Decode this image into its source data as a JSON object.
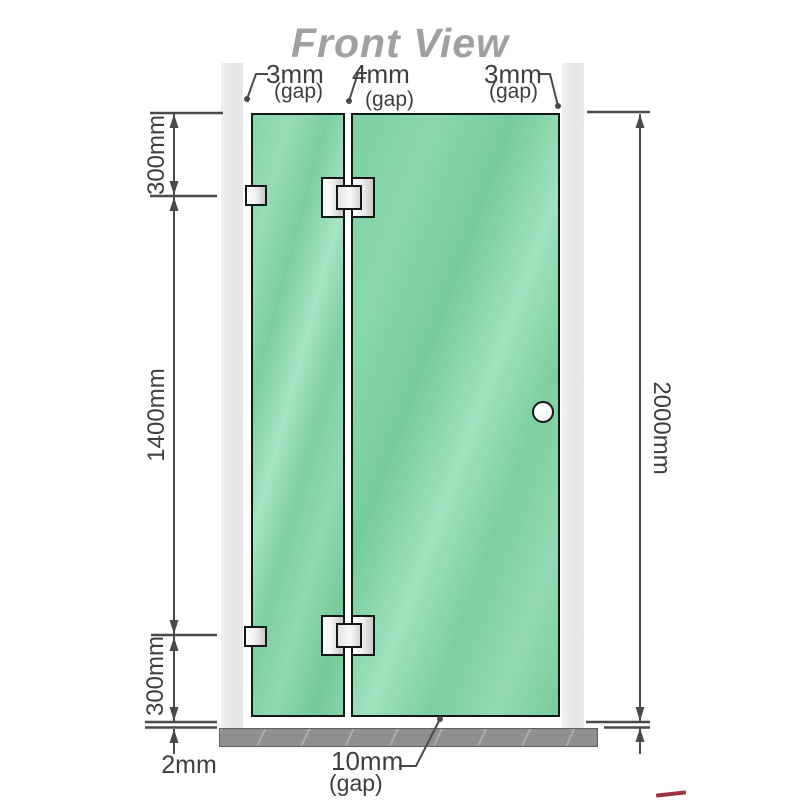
{
  "title": "Front View",
  "top_gaps": [
    {
      "value": "3mm",
      "unit": "(gap)"
    },
    {
      "value": "4mm",
      "unit": "(gap)"
    },
    {
      "value": "3mm",
      "unit": "(gap)"
    }
  ],
  "dims": {
    "left_top": "300mm",
    "left_middle": "1400mm",
    "left_bottom": "300mm",
    "right": "2000mm"
  },
  "bottom": {
    "floor_gap": "2mm",
    "door_gap_value": "10mm",
    "door_gap_unit": "(gap)"
  },
  "colors": {
    "glass_green": "#7ecfa0",
    "wall_gray": "#e8e8e8",
    "floor_gray": "#8f8f8f",
    "dimension_line": "#4a4a4a",
    "title_gray": "#a0a0a0"
  }
}
